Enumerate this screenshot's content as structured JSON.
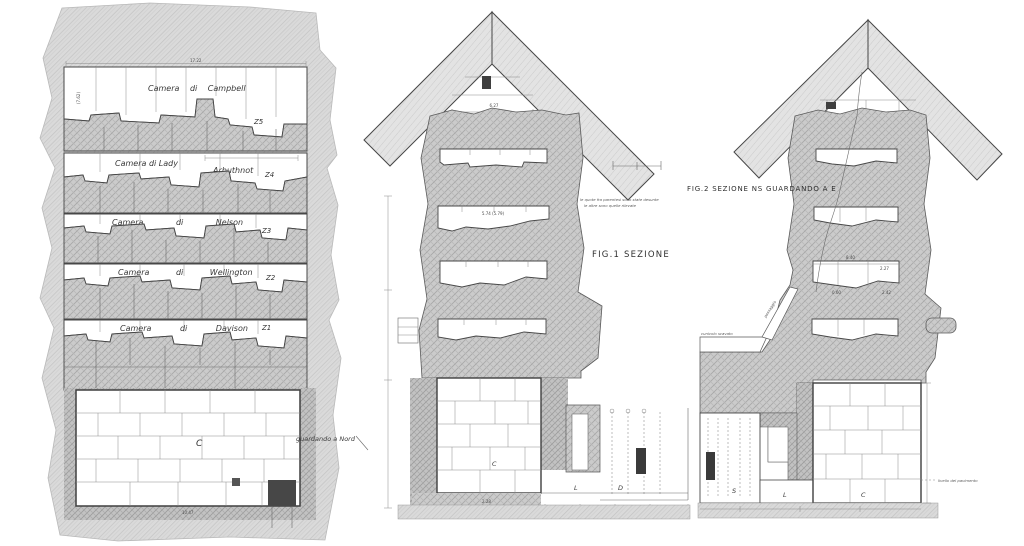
{
  "palette": {
    "paper": "#ffffff",
    "ink": "#474747",
    "hatch_light": "#dadada",
    "hatch_mid": "#cccccc",
    "dark_fill": "#3a3a3a"
  },
  "left_panel": {
    "chambers": [
      {
        "name": "Camera di Campbell",
        "code": "Z5"
      },
      {
        "name": "Camera di Lady",
        "name2": "Arbuthnot",
        "code": "Z4"
      },
      {
        "name": "Camera di Nelson",
        "code": "Z3"
      },
      {
        "name": "Camera di Wellington",
        "code": "Z2"
      },
      {
        "name": "Camera di Davison",
        "code": "Z1"
      }
    ],
    "kings_chamber_label": "C",
    "view_note": "guardando a Nord",
    "dim_top": "17.22",
    "dim_bottom": "10.47",
    "dim_side": "(7.62)"
  },
  "middle_panel": {
    "figure_label": "FIG.1 SEZIONE",
    "note_line1": "le quote fra parentesi sono state desunte",
    "note_line2": "le altre sono quelle rilevate",
    "dim_apex": "6.27",
    "dim_slot": "5.74 (5.79)",
    "dim_floor": "2.28",
    "kings_chamber_label": "C",
    "passage_label": "L",
    "antechamber_label": "D"
  },
  "right_panel": {
    "figure_label": "FIG.2 SEZIONE NS GUARDANDO A E",
    "kings_chamber_label": "C",
    "passage_label": "L",
    "serdab_label": "S",
    "tunnel_label": "passaggio",
    "tunnel_label2": "cunicolo scavato",
    "level_note": "livello del pavimento",
    "dim_a": "8.40",
    "dim_b": "2.27",
    "dim_c": "0.60",
    "dim_d": "2.42"
  }
}
